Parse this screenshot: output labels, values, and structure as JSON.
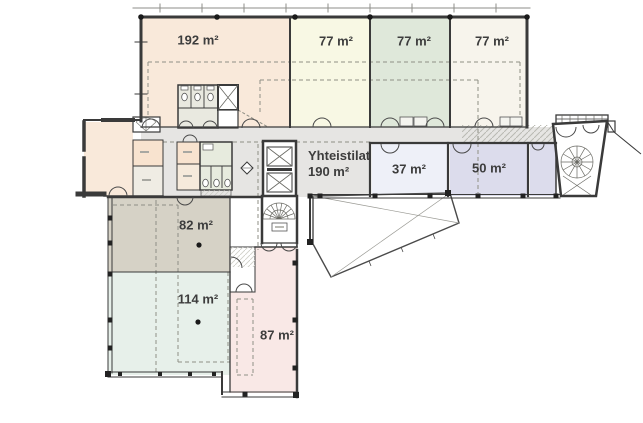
{
  "canvas": {
    "width": 643,
    "height": 423,
    "background": "#ffffff"
  },
  "floorplan": {
    "rooms": [
      {
        "name": "hall-top-left",
        "area_label": "192 m²",
        "fill": "#f9e9da"
      },
      {
        "name": "room-77-left",
        "area_label": "77 m²",
        "fill": "#f8f8e4"
      },
      {
        "name": "room-77-middle",
        "area_label": "77 m²",
        "fill": "#dfe8da"
      },
      {
        "name": "room-77-right",
        "area_label": "77 m²",
        "fill": "#f7f4ec"
      },
      {
        "name": "common-area",
        "title_label": "Yhteistilat",
        "area_label": "190 m²",
        "fill": "#e6e5e3"
      },
      {
        "name": "room-37",
        "area_label": "37 m²",
        "fill": "#eef0f8"
      },
      {
        "name": "room-50",
        "area_label": "50 m²",
        "fill": "#dcdcec"
      },
      {
        "name": "room-right-unlabeled",
        "area_label": "",
        "fill": "#dcdcec"
      },
      {
        "name": "room-82",
        "area_label": "82 m²",
        "fill": "#d6d2c6"
      },
      {
        "name": "room-114",
        "area_label": "114 m²",
        "fill": "#e7f0ea"
      },
      {
        "name": "room-87",
        "area_label": "87 m²",
        "fill": "#f9e8e6"
      },
      {
        "name": "entry-room-left",
        "area_label": "",
        "fill": "#f9e9da"
      }
    ],
    "palette": {
      "wall": "#3a3a3a",
      "corridor": "#e6e5e3",
      "dashed_line": "#8f8f85",
      "wc_block_top": "#e9e9e0",
      "wc_block_mid": "#e7ebde",
      "small_room_peach": "#f8e3cf",
      "small_room_beige": "#efece4",
      "label_text": "#3d3d3d"
    }
  }
}
